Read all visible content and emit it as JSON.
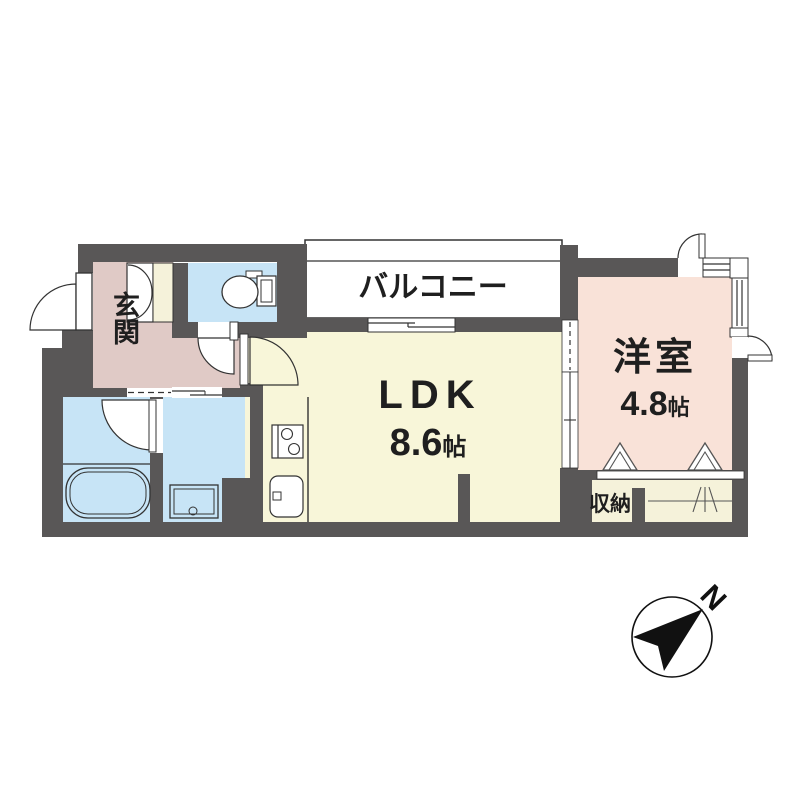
{
  "rooms": {
    "balcony": {
      "label": "バルコニー"
    },
    "entrance": {
      "label": "玄関"
    },
    "ldk": {
      "label": "LDK",
      "area_size": "8.6",
      "area_unit": "帖"
    },
    "western_room": {
      "label": "洋室",
      "area_size": "4.8",
      "area_unit": "帖"
    },
    "storage": {
      "label": "収納"
    }
  },
  "compass": {
    "north_label": "N"
  },
  "colors": {
    "wall": "#595757",
    "ldk_fill": "#F8F6D9",
    "western_room_fill": "#F9E2D8",
    "entrance_fill": "#E0CAC6",
    "water_rooms_fill": "#C7E4F6",
    "closet_fill": "#F5F2DA",
    "balcony_fill": "#FFFFFF",
    "line": "#333333"
  }
}
